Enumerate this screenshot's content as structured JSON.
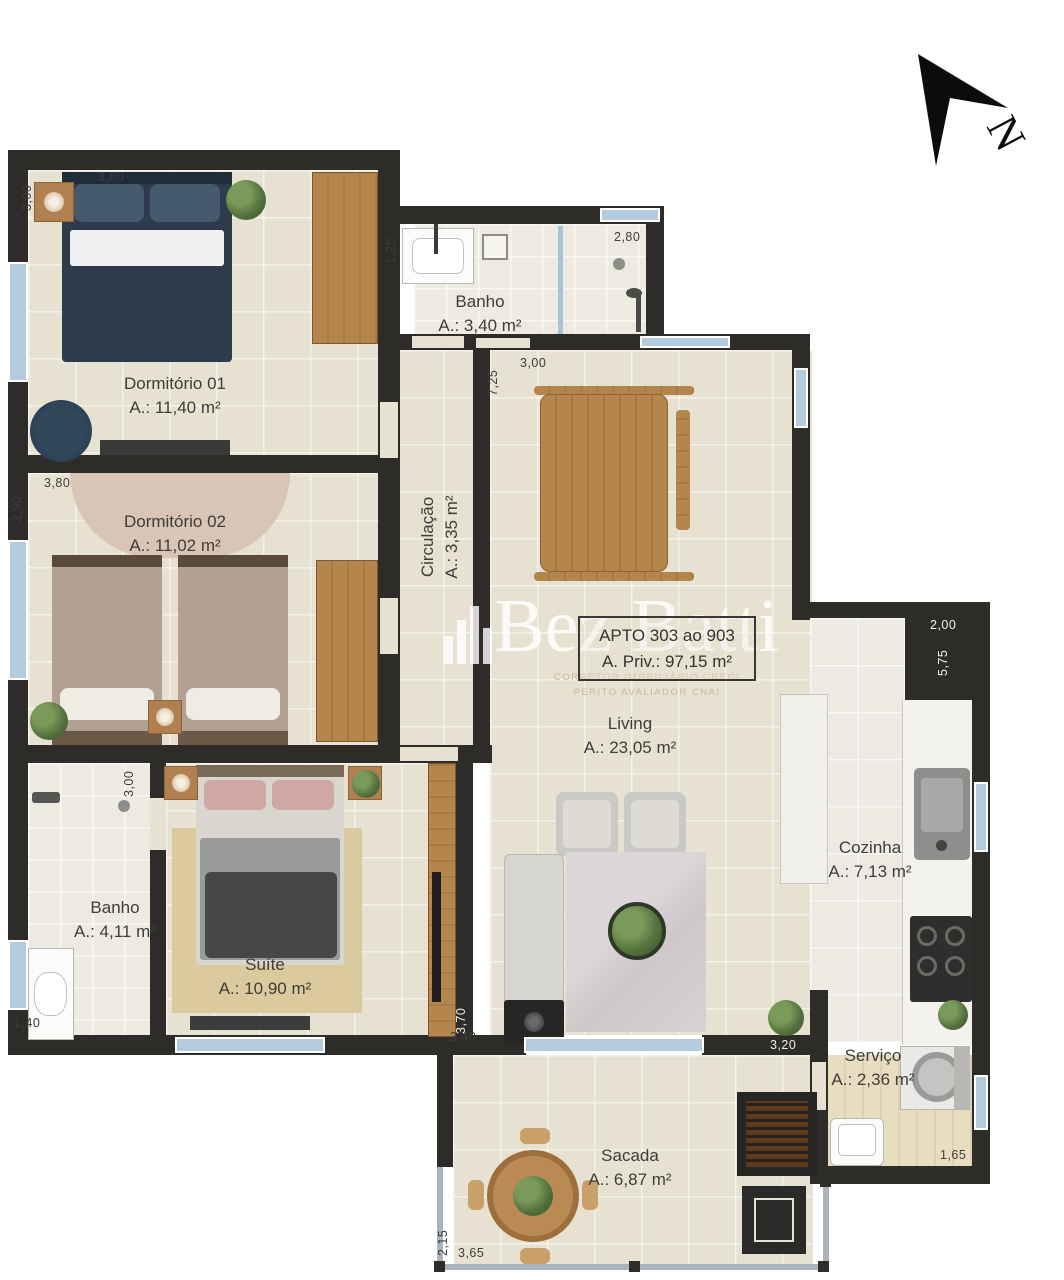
{
  "plan": {
    "unit_label": "APTO 303 ao 903",
    "private_area": "A. Priv.: 97,15 m²",
    "north_label": "N"
  },
  "watermark": {
    "brand": "Bez Batti",
    "line1": "CORRETOR IMOBILIÁRIO CRECI",
    "line2": "PERITO AVALIADOR CNAI"
  },
  "rooms": {
    "dorm1": {
      "name": "Dormitório 01",
      "area": "A.: 11,40 m²"
    },
    "dorm2": {
      "name": "Dormitório 02",
      "area": "A.: 11,02 m²"
    },
    "banho1": {
      "name": "Banho",
      "area": "A.: 3,40 m²"
    },
    "circ": {
      "name": "Circulação",
      "area": "A.: 3,35 m²"
    },
    "living": {
      "name": "Living",
      "area": "A.: 23,05 m²"
    },
    "cozinha": {
      "name": "Cozinha",
      "area": "A.: 7,13 m²"
    },
    "banho2": {
      "name": "Banho",
      "area": "A.: 4,11 m²"
    },
    "suite": {
      "name": "Suíte",
      "area": "A.: 10,90 m²"
    },
    "servico": {
      "name": "Serviço",
      "area": "A.: 2,36 m²"
    },
    "sacada": {
      "name": "Sacada",
      "area": "A.: 6,87 m²"
    }
  },
  "dims": {
    "dorm1_w": "3,80",
    "dorm1_h": "3,00",
    "banho1_h": "1,25",
    "banho1_w": "2,80",
    "dining_h": "7,25",
    "dining_w": "3,00",
    "dorm2_w": "3,80",
    "dorm2_h": "2,90",
    "suite_h": "3,00",
    "banho2_w": "1,40",
    "suite_w": "3,40",
    "suite_d": "3,70",
    "living_w": "3,20",
    "coz_w": "2,00",
    "coz_h": "5,75",
    "serv_w": "1,65",
    "sacada_h": "2,15",
    "sacada_w": "3,65"
  }
}
